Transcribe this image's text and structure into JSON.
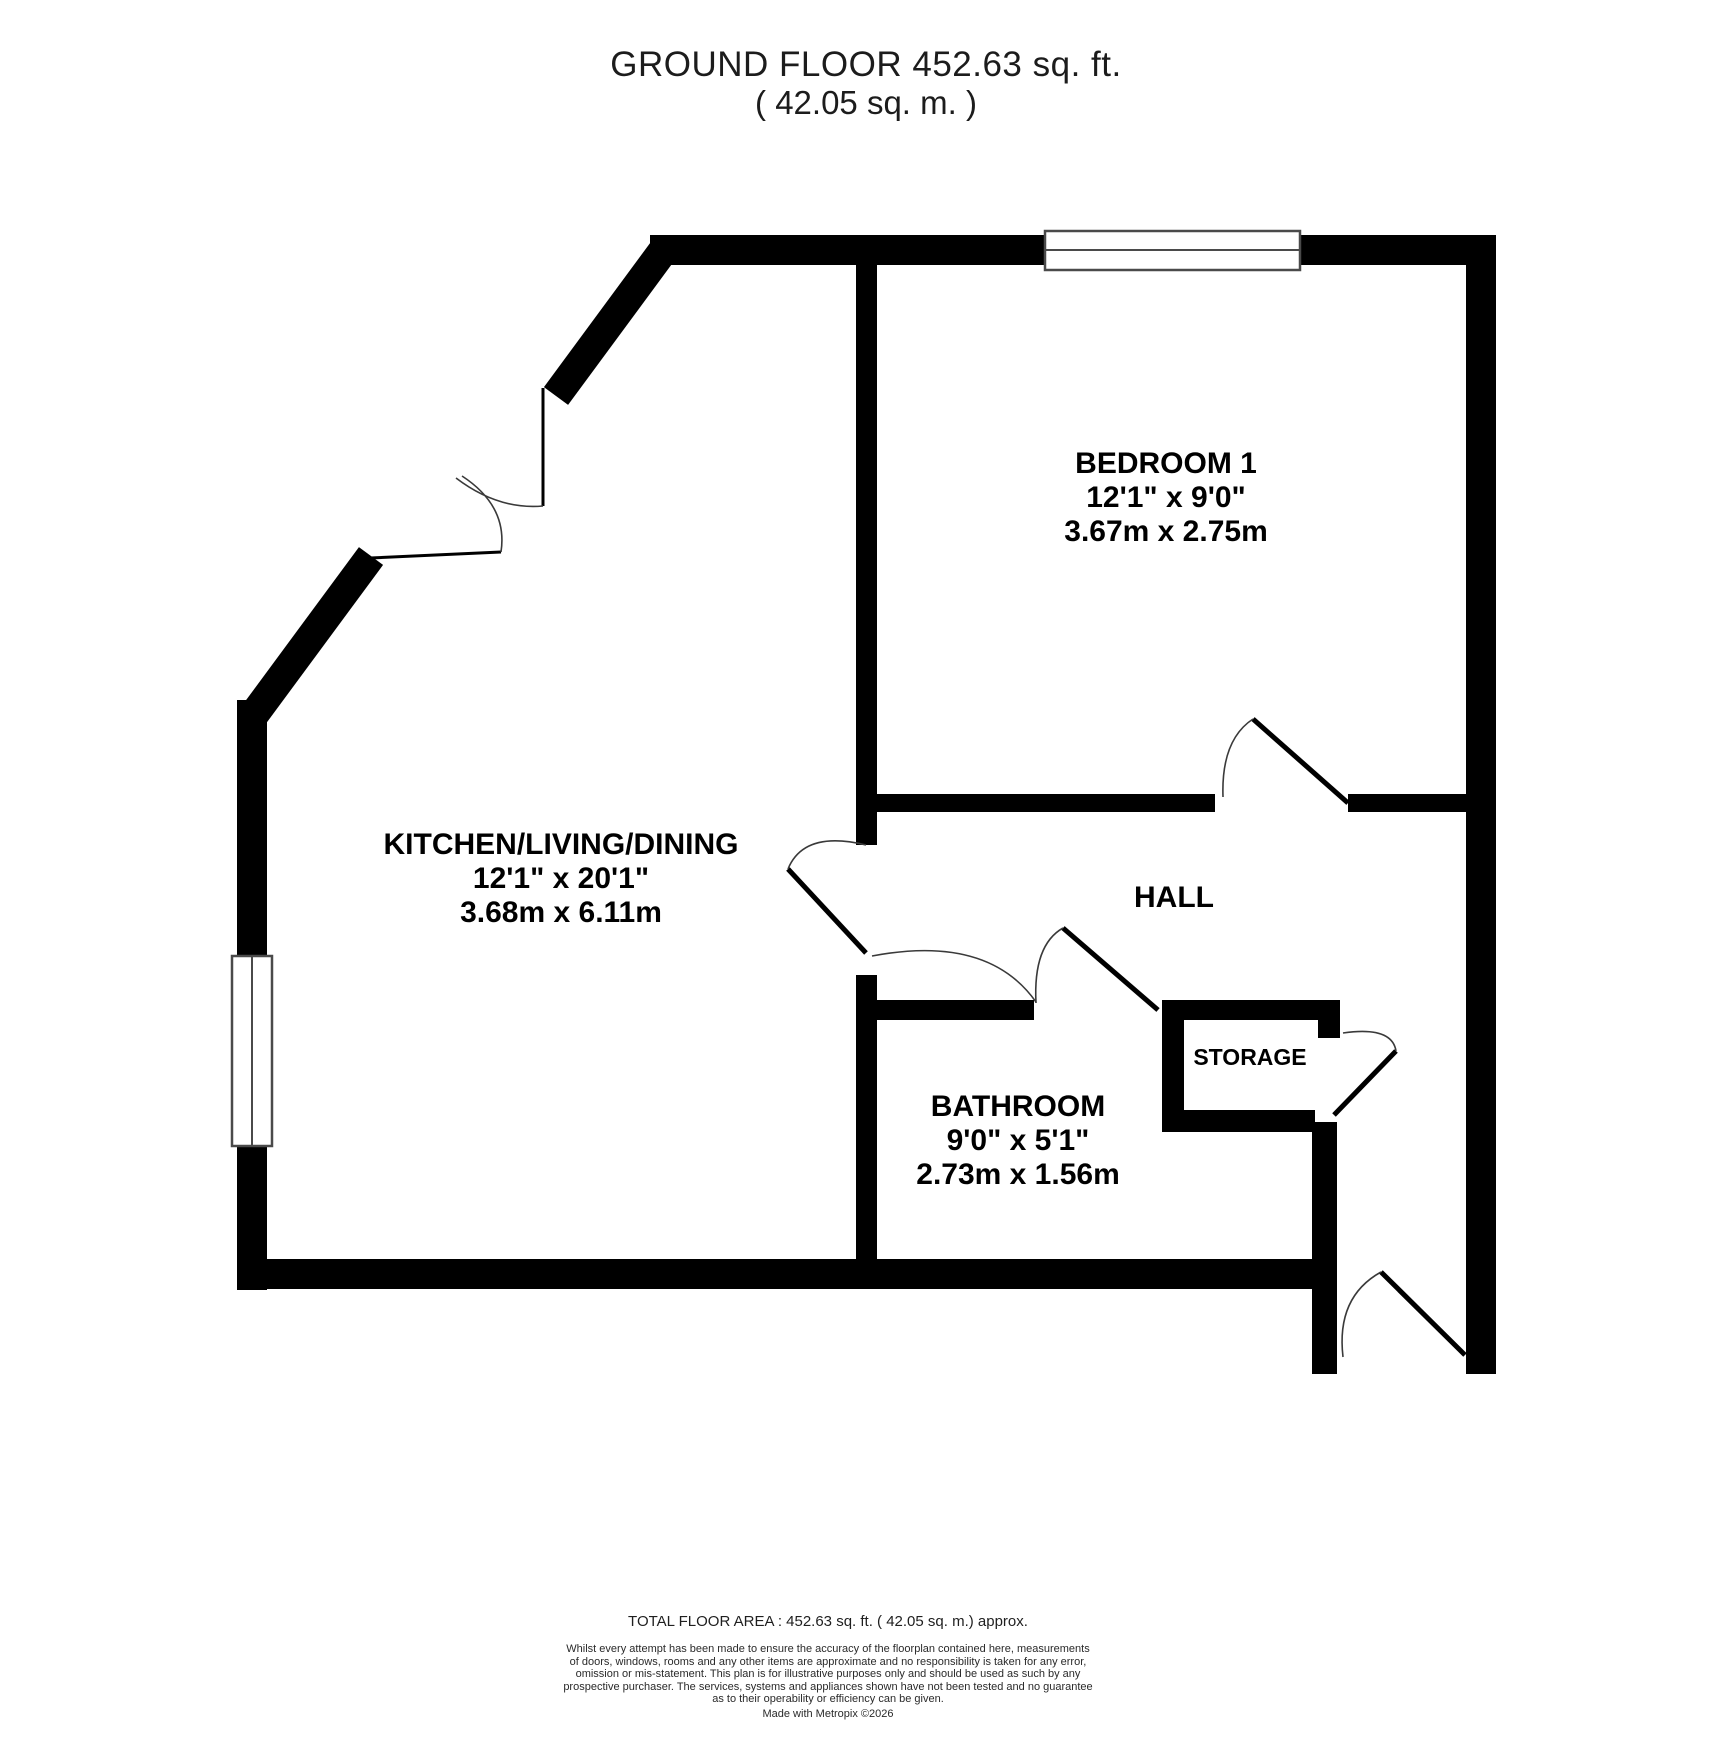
{
  "title": {
    "line1": "GROUND FLOOR 452.63 sq. ft.",
    "line2": "( 42.05 sq. m. )"
  },
  "rooms": {
    "bedroom": {
      "name": "BEDROOM 1",
      "imperial": "12'1\" x 9'0\"",
      "metric": "3.67m x 2.75m"
    },
    "kitchen": {
      "name": "KITCHEN/LIVING/DINING",
      "imperial": "12'1\" x 20'1\"",
      "metric": "3.68m x 6.11m"
    },
    "hall": {
      "name": "HALL"
    },
    "bathroom": {
      "name": "BATHROOM",
      "imperial": "9'0\" x 5'1\"",
      "metric": "2.73m x 1.56m"
    },
    "storage": {
      "name": "STORAGE"
    }
  },
  "footer": {
    "total": "TOTAL FLOOR AREA : 452.63 sq. ft. ( 42.05 sq. m.) approx.",
    "disclaimer": {
      "line1": "Whilst every attempt has been made to ensure the accuracy of the floorplan contained here, measurements",
      "line2": "of doors, windows, rooms and any other items are approximate and no responsibility is taken for any error,",
      "line3": "omission or mis-statement. This plan is for illustrative purposes only and should be used as such by any",
      "line4": "prospective purchaser. The services, systems and appliances shown have not been tested and no guarantee",
      "line5": "as to their operability or efficiency can be given."
    },
    "credit": "Made with Metropix ©2026"
  },
  "colors": {
    "wall": "#000000",
    "background": "#ffffff",
    "window_frame": "#4a4a4a",
    "door_arc": "#3a3a3a"
  }
}
